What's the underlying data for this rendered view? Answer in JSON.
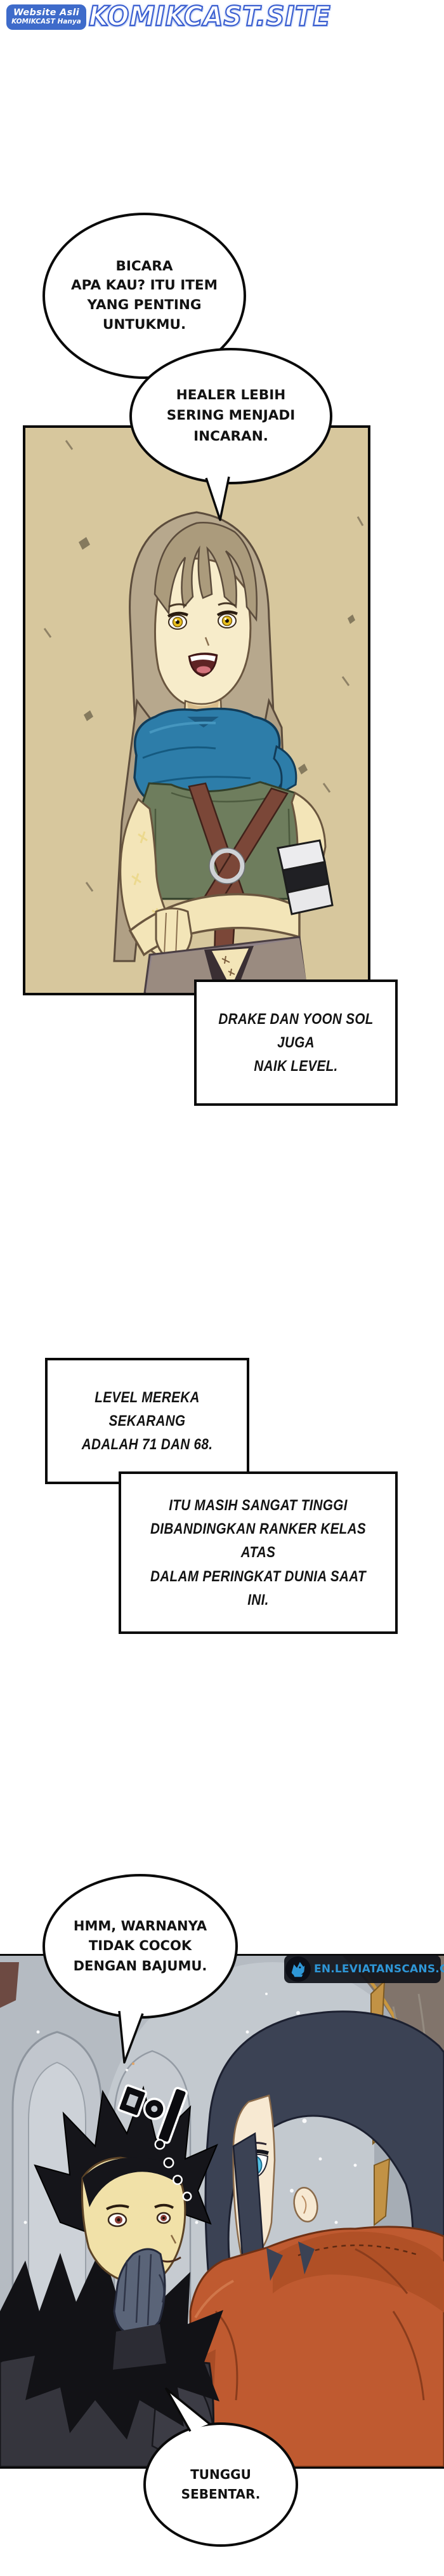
{
  "header": {
    "badge": {
      "line1": "Website Asli",
      "line2": "KOMIKCAST Hanya",
      "bg_color": "#3e6bca",
      "text_color": "#ffffff"
    },
    "logo": {
      "text": "KOMIKCAST.SITE",
      "fill_color": "#ffffff",
      "outline_color": "#3a5ed0",
      "glow_color": "#c3d3f5"
    }
  },
  "bubbles": {
    "b1": {
      "text": "BICARA\nAPA KAU? ITU ITEM\nYANG PENTING\nUNTUKMU."
    },
    "b2": {
      "text": "HEALER LEBIH\nSERING MENJADI\nINCARAN."
    },
    "b3": {
      "text": "HMM, WARNANYA\nTIDAK COCOK\nDENGAN BAJUMU."
    },
    "b4": {
      "text": "TUNGGU\nSEBENTAR."
    }
  },
  "captions": {
    "c1": {
      "text": "DRAKE DAN YOON SOL JUGA\nNAIK LEVEL."
    },
    "c2": {
      "text": "LEVEL MEREKA SEKARANG\nADALAH 71 DAN 68."
    },
    "c3": {
      "text": "ITU MASIH SANGAT TINGGI\nDIBANDINGKAN RANKER KELAS ATAS\nDALAM PERINGKAT DUNIA SAAT INI."
    }
  },
  "watermark": {
    "text": "EN.LEVIATANSCANS.COM",
    "text_color": "#2e96d6",
    "bg_color": "#10121a",
    "icon": "leviatan-dragon-icon"
  },
  "sfx": {
    "text": "흠...",
    "note": "rotated black glyph with white outline and trailing dots"
  },
  "panels": {
    "panel1": {
      "bg_color": "#d7c79d",
      "art": "healer-character"
    },
    "panel2": {
      "bg_color": "#b5bbc2",
      "art": "cathedral-scene-two-characters"
    }
  }
}
